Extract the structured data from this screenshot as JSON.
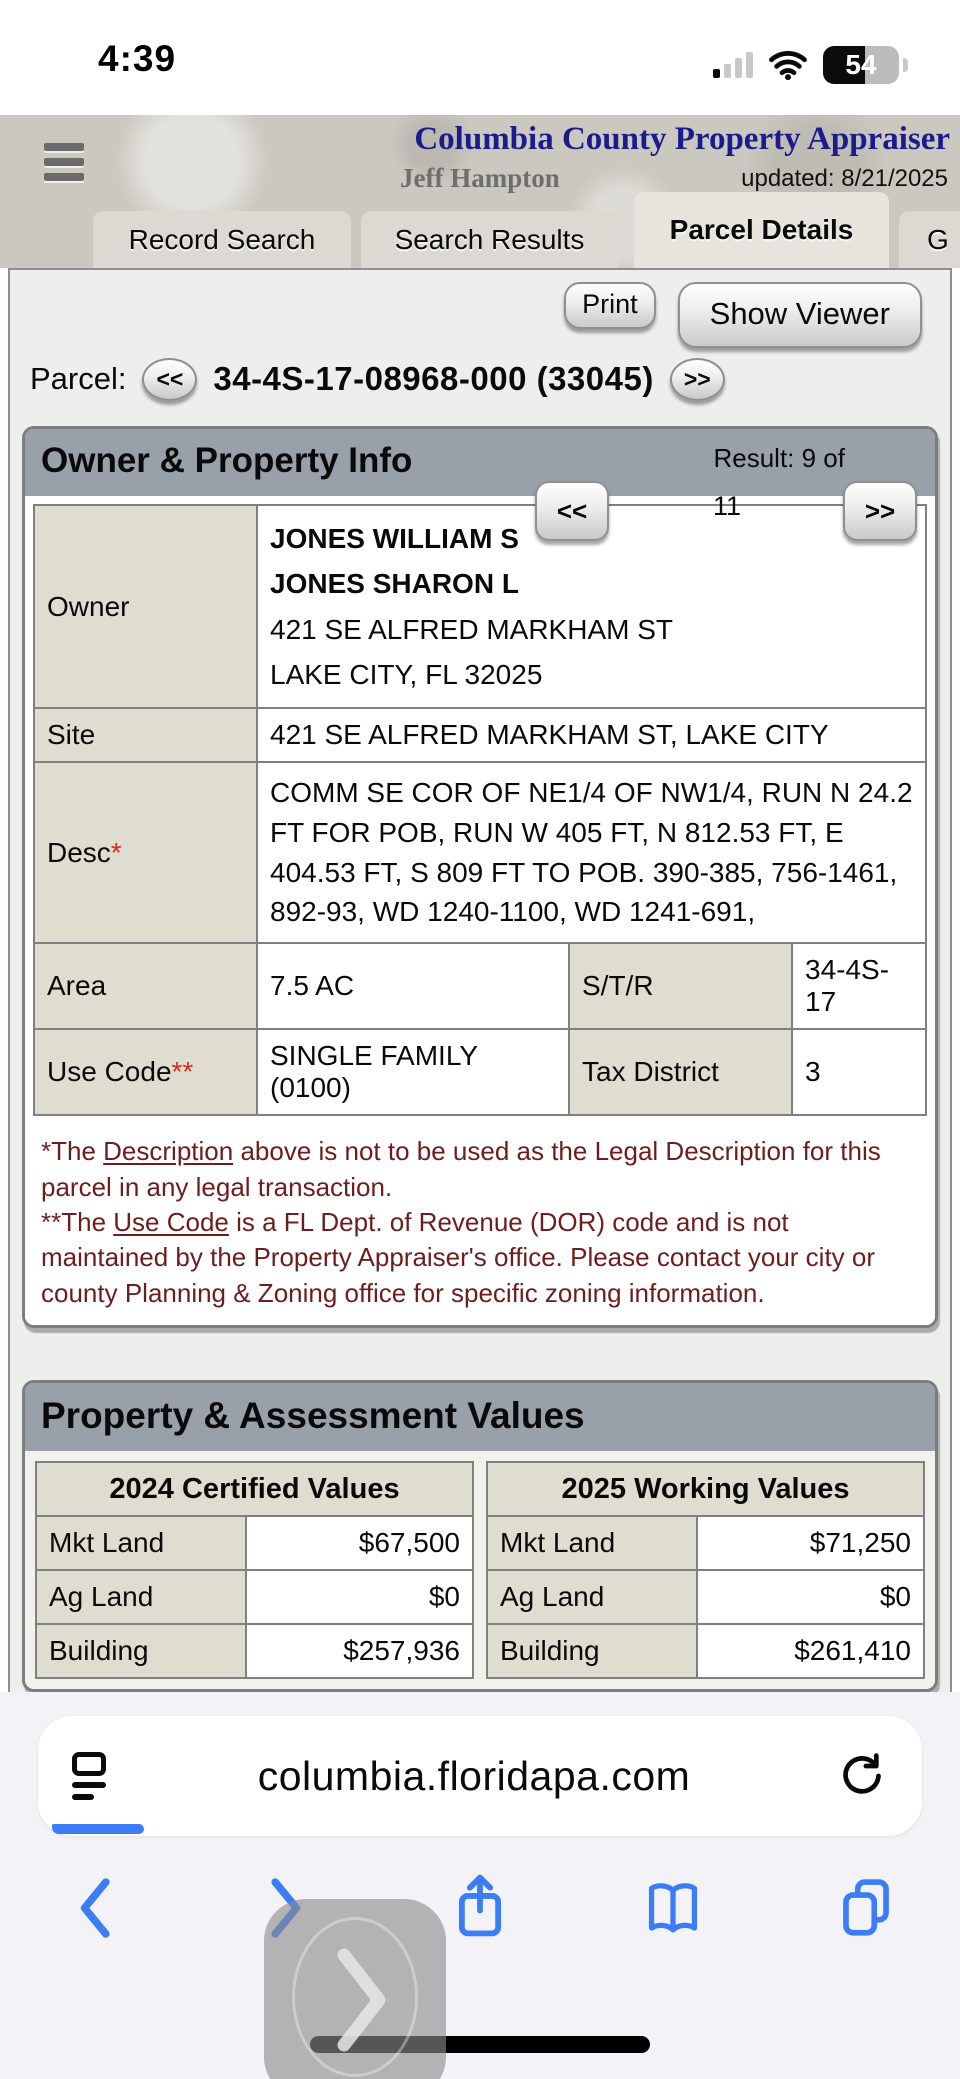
{
  "colors": {
    "accent_blue": "#3b7cf7",
    "title_navy": "#1b1b8e",
    "footnote_maroon": "#6e1d1d",
    "panel_header_gray": "#98a1a9",
    "label_beige": "#dfddd0"
  },
  "status_bar": {
    "time": "4:39",
    "battery_percent": "54"
  },
  "header": {
    "title": "Columbia County Property Appraiser",
    "appraiser": "Jeff Hampton",
    "updated": "updated: 8/21/2025",
    "tabs": [
      {
        "label": "Record Search"
      },
      {
        "label": "Search Results"
      },
      {
        "label": "Parcel Details"
      },
      {
        "label": "G"
      }
    ]
  },
  "toolbar": {
    "print_label": "Print",
    "show_viewer_label": "Show Viewer"
  },
  "parcel_nav": {
    "label": "Parcel:",
    "prev": "<<",
    "number": "34-4S-17-08968-000 (33045)",
    "next": ">>"
  },
  "owner_panel": {
    "title": "Owner & Property Info",
    "result_label": "Result: 9 of",
    "result_count": "11",
    "prev": "<<",
    "next": ">>",
    "rows": {
      "owner_label": "Owner",
      "owner_lines": [
        "JONES WILLIAM S",
        "JONES SHARON L",
        "421 SE ALFRED MARKHAM ST",
        "LAKE CITY, FL 32025"
      ],
      "site_label": "Site",
      "site_value": "421 SE ALFRED MARKHAM ST, LAKE CITY",
      "desc_label": "Desc",
      "desc_mark": "*",
      "desc_value": "COMM SE COR OF NE1/4 OF NW1/4, RUN N 24.2 FT FOR POB, RUN W 405 FT, N 812.53 FT, E 404.53 FT, S 809 FT TO POB. 390-385, 756-1461, 892-93, WD 1240-1100, WD 1241-691,",
      "area_label": "Area",
      "area_value": "7.5 AC",
      "str_label": "S/T/R",
      "str_value": "34-4S-17",
      "usecode_label": "Use Code",
      "usecode_mark": "**",
      "usecode_value": "SINGLE FAMILY (0100)",
      "taxdist_label": "Tax District",
      "taxdist_value": "3"
    },
    "footnotes": {
      "fn1_pre": "*The ",
      "fn1_underlined": "Description",
      "fn1_post": " above is not to be used as the Legal Description for this parcel in any legal transaction.",
      "fn2_pre": "**The ",
      "fn2_underlined": "Use Code",
      "fn2_post": " is a FL Dept. of Revenue (DOR) code and is not maintained by the Property Appraiser's office. Please contact your city or county Planning & Zoning office for specific zoning information."
    }
  },
  "values_panel": {
    "title": "Property & Assessment Values",
    "left": {
      "header": "2024 Certified Values",
      "rows": [
        [
          "Mkt Land",
          "$67,500"
        ],
        [
          "Ag Land",
          "$0"
        ],
        [
          "Building",
          "$257,936"
        ]
      ]
    },
    "right": {
      "header": "2025 Working Values",
      "rows": [
        [
          "Mkt Land",
          "$71,250"
        ],
        [
          "Ag Land",
          "$0"
        ],
        [
          "Building",
          "$261,410"
        ]
      ]
    }
  },
  "safari": {
    "url": "columbia.floridapa.com"
  }
}
